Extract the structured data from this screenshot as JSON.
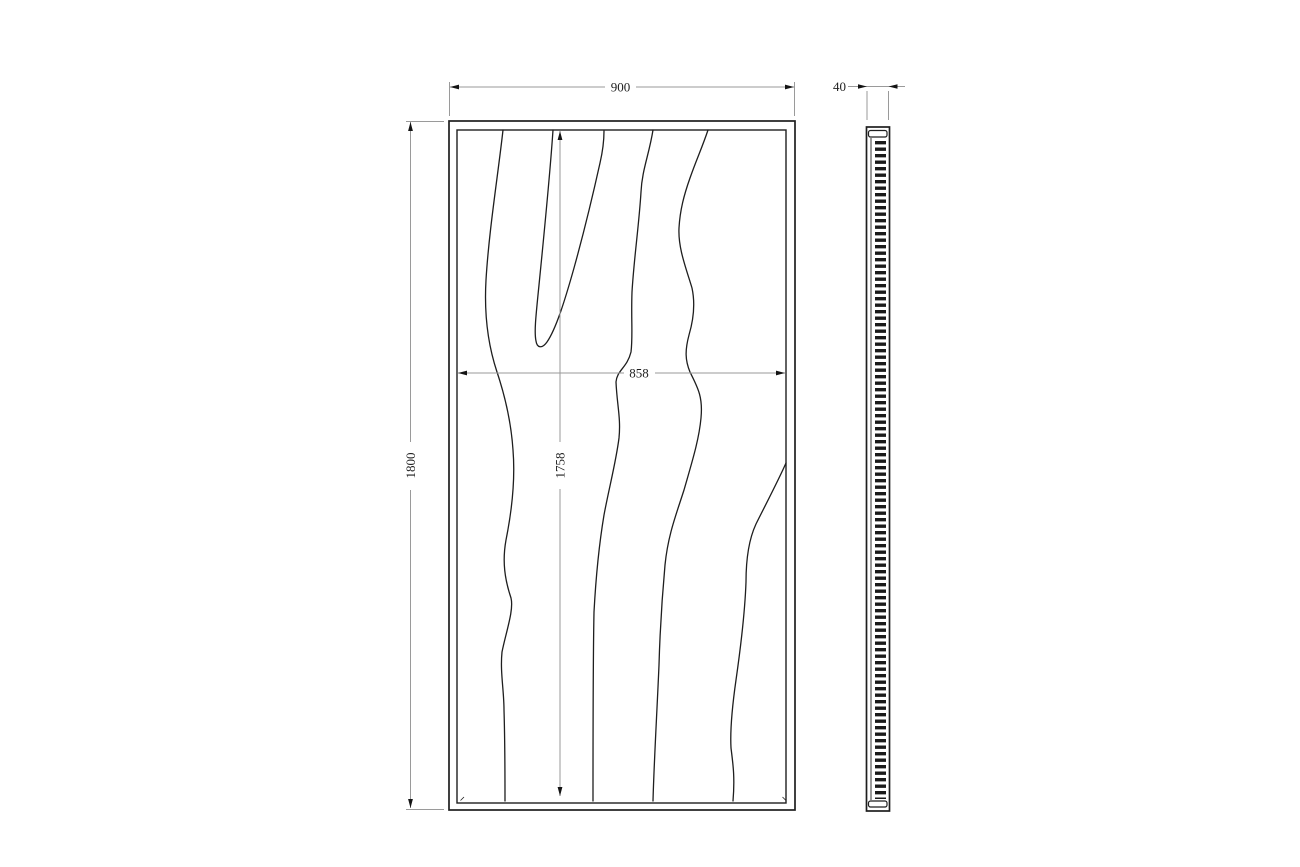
{
  "drawing": {
    "kind": "technical-drawing",
    "subject": "carved wood wall panel, front and side orthographic views",
    "views": {
      "front": {
        "label": "front-view",
        "dimensions": {
          "overall_width": "900",
          "overall_height": "1800",
          "inner_width": "858",
          "inner_height": "1758"
        },
        "grain_line_count": 5
      },
      "side": {
        "label": "side-view",
        "dimensions": {
          "thickness": "40"
        }
      }
    },
    "colors": {
      "background": "#ffffff",
      "object_line": "#1e1e1e",
      "dimension_line": "#9a9a9a",
      "dimension_text": "#1f1f1f",
      "arrowhead": "#141414"
    }
  }
}
